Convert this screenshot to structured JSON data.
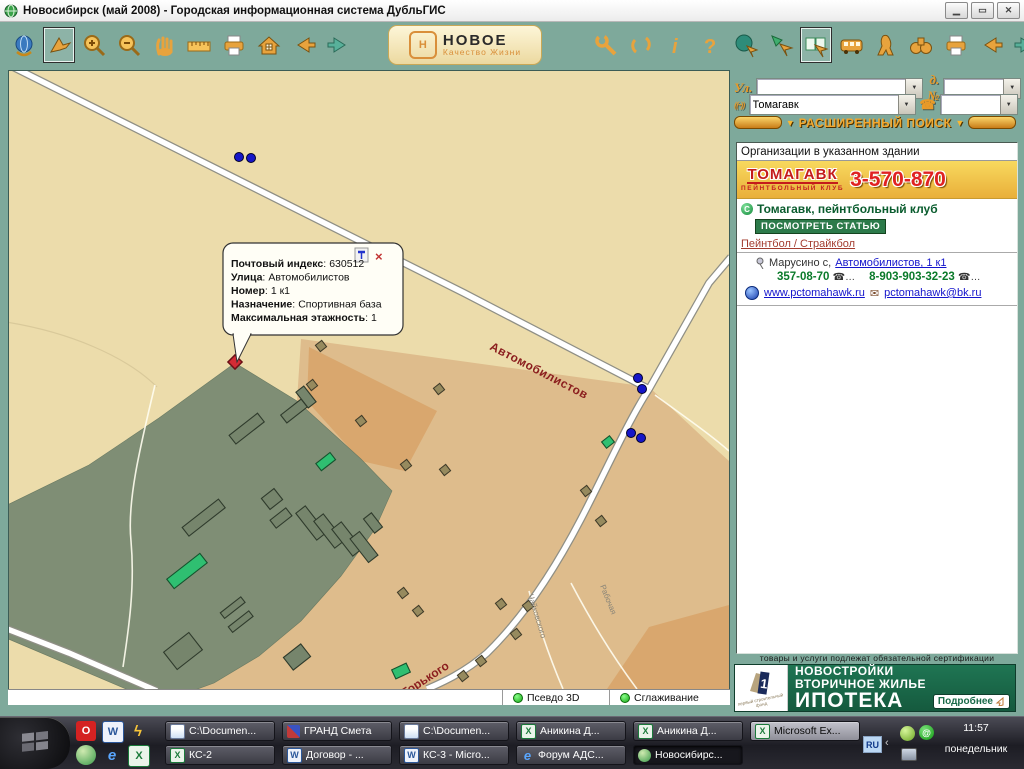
{
  "window": {
    "title": "Новосибирск (май 2008) - Городская информационная система ДубльГИС"
  },
  "toolbar": {
    "banner_line1": "НОВОЕ",
    "banner_line2": "Качество Жизни",
    "left_icons": [
      "globe",
      "select",
      "zoom-in",
      "zoom-out",
      "pan",
      "measure",
      "print",
      "home",
      "back",
      "forward"
    ],
    "right_icons": [
      "settings",
      "refresh",
      "info",
      "help",
      "map-select",
      "go-arrow",
      "directory",
      "transport",
      "pedestrian",
      "binoculars",
      "print",
      "back",
      "forward"
    ]
  },
  "search": {
    "street_label": "Ул.",
    "street_value": "",
    "house_label": "д.№",
    "house_value": "",
    "name_value": "Томагавк",
    "phone_value": "",
    "advanced_label": "РАСШИРЕННЫЙ ПОИСК"
  },
  "results": {
    "header": "Организации в указанном здании",
    "ad": {
      "brand": "ТОМАГАВК",
      "subtitle": "ПЕЙНТБОЛЬНЫЙ КЛУБ",
      "phone": "3-570-870"
    },
    "org": {
      "name": "Томагавк, пейнтбольный клуб",
      "view_article": "ПОСМОТРЕТЬ СТАТЬЮ",
      "rubric": "Пейнтбол / Страйкбол",
      "address_prefix": "Марусино с, ",
      "address_link": "Автомобилистов, 1 к1",
      "phone1": "357-08-70",
      "phone2": "8-903-903-32-23",
      "website": "www.pctomahawk.ru",
      "email": "pctomahawk@bk.ru"
    }
  },
  "cert_notice": "товары и услуги подлежат обязательной сертификации",
  "banner": {
    "logo": "первый строительный фонд",
    "line1": "НОВОСТРОЙКИ",
    "line2": "ВТОРИЧНОЕ ЖИЛЬЕ",
    "line3": "ИПОТЕКА",
    "more": "Подробнее"
  },
  "map": {
    "tooltip": {
      "separator": ":",
      "lines": [
        {
          "label": "Почтовый индекс",
          "value": "630512"
        },
        {
          "label": "Улица",
          "value": "Автомобилистов"
        },
        {
          "label": "Номер",
          "value": "1 к1"
        },
        {
          "label": "Назначение",
          "value": "Спортивная база"
        },
        {
          "label": "Максимальная этажность",
          "value": "1"
        }
      ]
    },
    "street_labels": [
      {
        "text": "Автомобилистов"
      },
      {
        "text": "Горького"
      },
      {
        "text": "Чайковского"
      },
      {
        "text": "Рабочая"
      }
    ],
    "status": {
      "pseudo3d": "Псевдо 3D",
      "smoothing": "Сглаживание"
    }
  },
  "taskbar": {
    "row1": [
      {
        "label": "C:\\Documen..."
      },
      {
        "label": "ГРАНД Смета"
      },
      {
        "label": "C:\\Documen..."
      },
      {
        "label": "Аникина Д..."
      },
      {
        "label": "Аникина Д..."
      },
      {
        "label": "Microsoft Ex..."
      }
    ],
    "row2": [
      {
        "label": "КС-2"
      },
      {
        "label": "Договор - ..."
      },
      {
        "label": "КС-3 - Micro..."
      },
      {
        "label": "Форум АДС..."
      },
      {
        "label": "Новосибирс..."
      }
    ],
    "tray": {
      "lang": "RU",
      "time": "11:57",
      "day": "понедельник"
    }
  }
}
